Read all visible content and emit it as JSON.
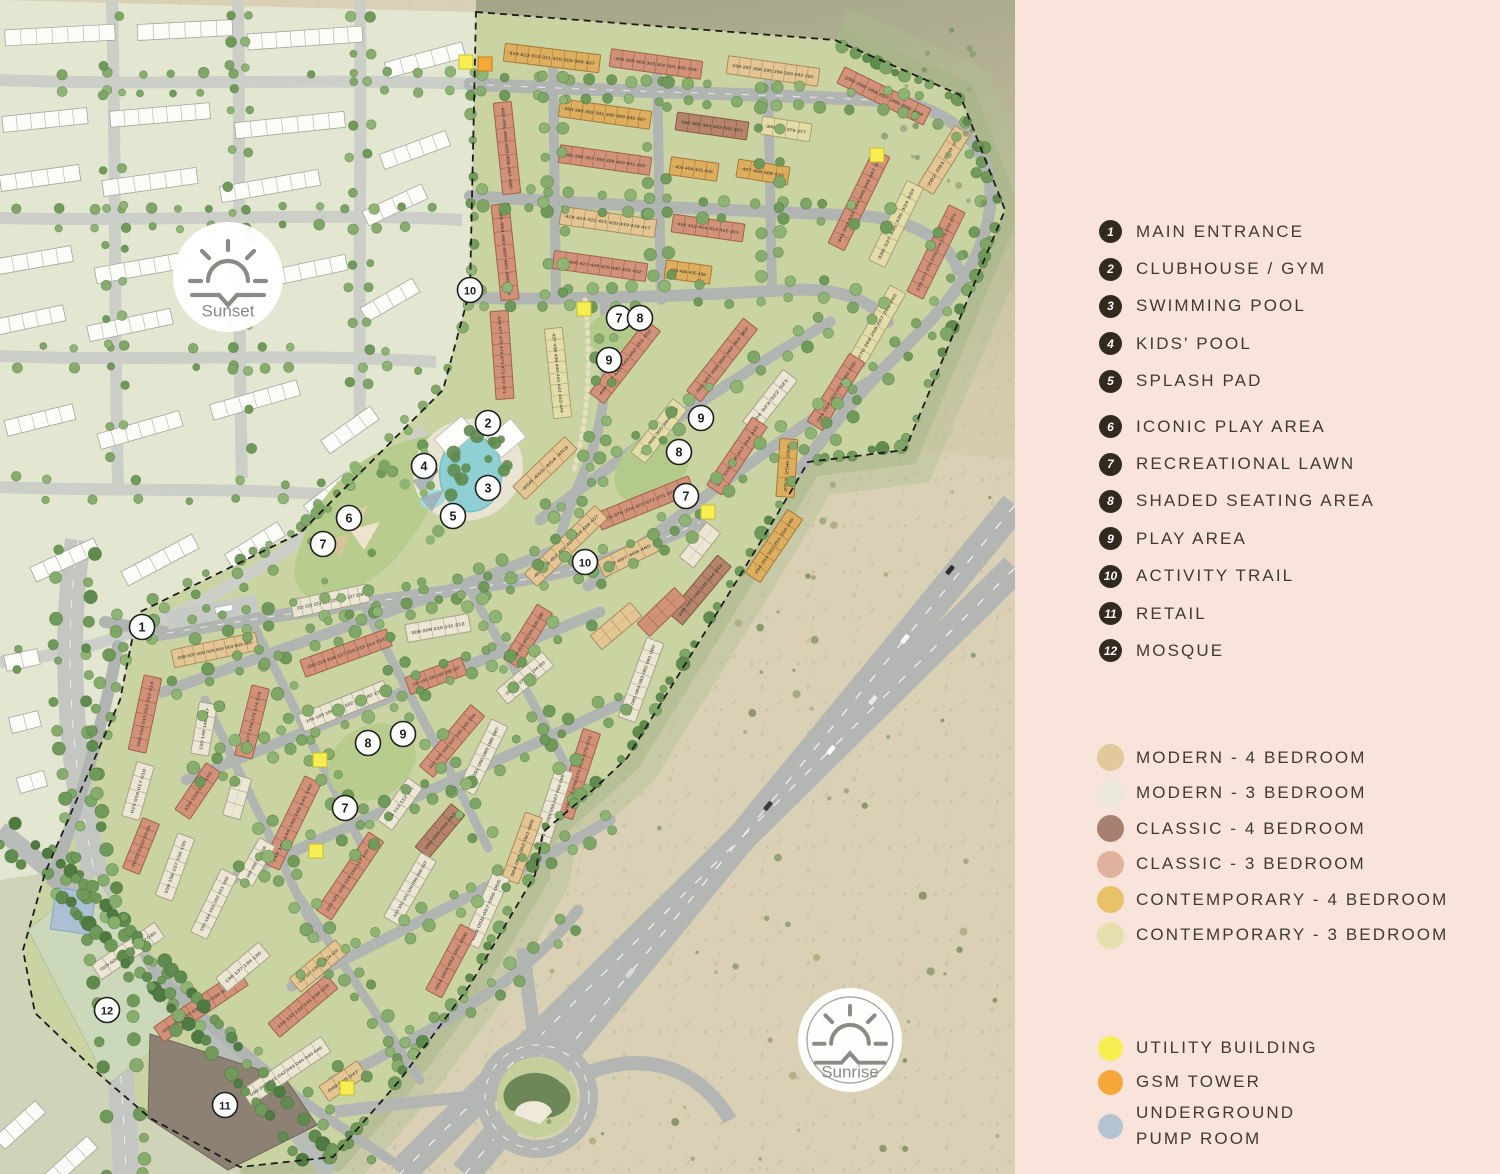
{
  "legend": {
    "amenities": [
      {
        "num": "1",
        "label": "MAIN ENTRANCE"
      },
      {
        "num": "2",
        "label": "CLUBHOUSE / GYM"
      },
      {
        "num": "3",
        "label": "SWIMMING POOL"
      },
      {
        "num": "4",
        "label": "KIDS' POOL"
      },
      {
        "num": "5",
        "label": "SPLASH PAD"
      },
      {
        "num": "6",
        "label": "ICONIC PLAY AREA"
      },
      {
        "num": "7",
        "label": "RECREATIONAL LAWN"
      },
      {
        "num": "8",
        "label": "SHADED SEATING AREA"
      },
      {
        "num": "9",
        "label": "PLAY AREA"
      },
      {
        "num": "10",
        "label": "ACTIVITY TRAIL"
      },
      {
        "num": "11",
        "label": "RETAIL"
      },
      {
        "num": "12",
        "label": "MOSQUE"
      }
    ],
    "unit_types": [
      {
        "label": "MODERN - 4 BEDROOM",
        "color": "#e2c99c"
      },
      {
        "label": "MODERN - 3 BEDROOM",
        "color": "#ebe8da"
      },
      {
        "label": "CLASSIC - 4 BEDROOM",
        "color": "#a8806f"
      },
      {
        "label": "CLASSIC - 3 BEDROOM",
        "color": "#e0b19c"
      },
      {
        "label": "CONTEMPORARY - 4 BEDROOM",
        "color": "#e9c169"
      },
      {
        "label": "CONTEMPORARY - 3 BEDROOM",
        "color": "#e6dfb0"
      }
    ],
    "facilities": [
      {
        "label": "UTILITY BUILDING",
        "color": "#f7ef52"
      },
      {
        "label": "GSM TOWER",
        "color": "#f6a73a"
      },
      {
        "label": "UNDERGROUND\nPUMP ROOM",
        "color": "#b5c4d2"
      }
    ]
  },
  "map": {
    "sun_badges": [
      {
        "type": "sunset",
        "label": "Sunset",
        "x": 228,
        "y": 277,
        "r": 55
      },
      {
        "type": "sunrise",
        "label": "Sunrise",
        "x": 850,
        "y": 1040,
        "r": 52
      }
    ],
    "markers": [
      {
        "n": "1",
        "x": 142,
        "y": 627
      },
      {
        "n": "2",
        "x": 488,
        "y": 423
      },
      {
        "n": "4",
        "x": 424,
        "y": 466
      },
      {
        "n": "3",
        "x": 488,
        "y": 488
      },
      {
        "n": "5",
        "x": 453,
        "y": 516
      },
      {
        "n": "6",
        "x": 349,
        "y": 518
      },
      {
        "n": "7",
        "x": 323,
        "y": 544
      },
      {
        "n": "10",
        "x": 470,
        "y": 290
      },
      {
        "n": "7",
        "x": 619,
        "y": 318
      },
      {
        "n": "8",
        "x": 640,
        "y": 318
      },
      {
        "n": "9",
        "x": 609,
        "y": 360
      },
      {
        "n": "9",
        "x": 701,
        "y": 418
      },
      {
        "n": "8",
        "x": 679,
        "y": 452
      },
      {
        "n": "7",
        "x": 686,
        "y": 496
      },
      {
        "n": "10",
        "x": 585,
        "y": 562
      },
      {
        "n": "9",
        "x": 403,
        "y": 734
      },
      {
        "n": "8",
        "x": 368,
        "y": 743
      },
      {
        "n": "7",
        "x": 345,
        "y": 808
      },
      {
        "n": "12",
        "x": 107,
        "y": 1010
      },
      {
        "n": "11",
        "x": 225,
        "y": 1105
      }
    ],
    "building_rows": [
      [
        552,
        58,
        96,
        7,
        "t4",
        "314 - 307"
      ],
      [
        656,
        64,
        92,
        8,
        "c3",
        "306 - 299"
      ],
      [
        773,
        71,
        92,
        8,
        "m4",
        "298 - 291"
      ],
      [
        884,
        96,
        96,
        26,
        "c3",
        "290 - 284"
      ],
      [
        944,
        160,
        70,
        -58,
        "m4",
        "282 - 279"
      ],
      [
        605,
        114,
        92,
        8,
        "t4",
        "394 - 387"
      ],
      [
        712,
        126,
        72,
        8,
        "c4",
        "386 - 381"
      ],
      [
        786,
        129,
        50,
        9,
        "t3",
        "380 - 377"
      ],
      [
        605,
        160,
        92,
        8,
        "c3",
        "395 - 402"
      ],
      [
        694,
        169,
        48,
        8,
        "t4",
        "403 - 406"
      ],
      [
        763,
        172,
        52,
        9,
        "t4",
        "407 - 410"
      ],
      [
        608,
        222,
        96,
        8,
        "m4",
        "424 - 417"
      ],
      [
        708,
        228,
        72,
        8,
        "c3",
        "416 - 411"
      ],
      [
        600,
        266,
        94,
        8,
        "c3",
        "425 - 432"
      ],
      [
        688,
        272,
        46,
        8,
        "t4",
        "433 - 436"
      ],
      [
        507,
        148,
        92,
        84,
        "c3",
        "492 - 486"
      ],
      [
        505,
        252,
        96,
        84,
        "c3",
        "485 - 479"
      ],
      [
        502,
        355,
        88,
        86,
        "c3",
        "478 - 471"
      ],
      [
        558,
        373,
        90,
        84,
        "t3",
        "437 - 444"
      ],
      [
        859,
        200,
        104,
        -64,
        "c3",
        "341 - 348"
      ],
      [
        896,
        224,
        88,
        -64,
        "t3",
        "338 - 333"
      ],
      [
        936,
        252,
        96,
        -64,
        "c3",
        "278 - 271"
      ],
      [
        877,
        326,
        84,
        -60,
        "t3",
        "270 - 265"
      ],
      [
        836,
        392,
        80,
        -58,
        "c3",
        "264 - 259"
      ],
      [
        625,
        362,
        92,
        -52,
        "c3",
        "446 - 452"
      ],
      [
        722,
        360,
        92,
        -52,
        "c3",
        "356 - 362"
      ],
      [
        770,
        401,
        66,
        -52,
        "m3",
        "324 - 321"
      ],
      [
        737,
        456,
        82,
        -56,
        "c3",
        "320 - 315"
      ],
      [
        659,
        431,
        68,
        -52,
        "t3",
        "367 - 363"
      ],
      [
        645,
        503,
        100,
        -22,
        "c3",
        "376 - 369"
      ],
      [
        787,
        468,
        58,
        -86,
        "t4",
        "257 - 255"
      ],
      [
        774,
        546,
        76,
        -56,
        "t4",
        "254 - 249"
      ],
      [
        545,
        468,
        72,
        -44,
        "m4",
        "456 - 453"
      ],
      [
        566,
        546,
        98,
        -44,
        "m4",
        "464 - 457"
      ],
      [
        628,
        556,
        60,
        -26,
        "m4",
        "468 - 465"
      ],
      [
        700,
        545,
        44,
        -52,
        "m3",
        null
      ],
      [
        700,
        590,
        76,
        -50,
        "c4",
        "248 - 243"
      ],
      [
        641,
        680,
        84,
        -70,
        "m3",
        "086 - 080"
      ],
      [
        616,
        626,
        52,
        -40,
        "m4",
        null
      ],
      [
        662,
        612,
        52,
        -44,
        "c3",
        null
      ],
      [
        330,
        601,
        78,
        -12,
        "m3",
        "221 - 228"
      ],
      [
        438,
        628,
        64,
        -10,
        "m3",
        "208 - 212"
      ],
      [
        346,
        653,
        92,
        -20,
        "c3",
        "220 - 213"
      ],
      [
        344,
        706,
        92,
        -22,
        "m3",
        "186 - 179"
      ],
      [
        436,
        676,
        60,
        -20,
        "c3",
        "192 - 187"
      ],
      [
        525,
        678,
        60,
        -40,
        "m3",
        "198 - 193"
      ],
      [
        528,
        636,
        64,
        -58,
        "c3",
        "204 - 199"
      ],
      [
        252,
        722,
        72,
        -76,
        "c3",
        "178 - 173"
      ],
      [
        204,
        729,
        52,
        -80,
        "m3",
        "150 - 147"
      ],
      [
        145,
        714,
        76,
        -78,
        "c3",
        "009 - 014"
      ],
      [
        215,
        650,
        86,
        -12,
        "m4",
        "008 - 001"
      ],
      [
        292,
        823,
        96,
        -64,
        "c3",
        "146 - 140"
      ],
      [
        198,
        791,
        56,
        -56,
        "c3",
        "154 - 151"
      ],
      [
        237,
        797,
        42,
        -74,
        "m3",
        "172 - 170"
      ],
      [
        400,
        804,
        52,
        -54,
        "m3",
        "114 - 111"
      ],
      [
        452,
        741,
        80,
        -50,
        "c3",
        "110 - 104"
      ],
      [
        483,
        757,
        76,
        -64,
        "m3",
        "092 - 087"
      ],
      [
        440,
        831,
        56,
        -50,
        "c4",
        "096 - 093"
      ],
      [
        350,
        876,
        94,
        -56,
        "c3",
        "122 - 115"
      ],
      [
        410,
        889,
        74,
        -60,
        "m3",
        "103 - 097"
      ],
      [
        175,
        867,
        66,
        -70,
        "m3",
        "159 - 155"
      ],
      [
        214,
        904,
        70,
        -64,
        "m3",
        "165 - 160"
      ],
      [
        256,
        862,
        46,
        -60,
        "m3",
        "169 - 166"
      ],
      [
        138,
        791,
        56,
        -74,
        "m3",
        "015 - 018"
      ],
      [
        141,
        846,
        54,
        -68,
        "c3",
        "019 - 024"
      ],
      [
        128,
        951,
        76,
        -34,
        "m3",
        "025 - 030"
      ],
      [
        201,
        1006,
        102,
        -34,
        "c3",
        "031 - 038"
      ],
      [
        286,
        1071,
        96,
        -34,
        "m3",
        "039 - 046"
      ],
      [
        318,
        966,
        60,
        -40,
        "m4",
        "128 - 123"
      ],
      [
        243,
        967,
        56,
        -40,
        "m3",
        "138 - 135"
      ],
      [
        303,
        1006,
        76,
        -40,
        "c3",
        "134 - 129"
      ],
      [
        343,
        1081,
        46,
        -34,
        "m4",
        "049 - 047"
      ],
      [
        578,
        774,
        90,
        -72,
        "c3",
        "078 - 072"
      ],
      [
        552,
        808,
        80,
        -72,
        "m3",
        "071 - 065"
      ],
      [
        522,
        848,
        70,
        -70,
        "m4",
        "064 - 060"
      ],
      [
        486,
        910,
        76,
        -66,
        "m3",
        "059 - 055"
      ],
      [
        451,
        961,
        74,
        -62,
        "c3",
        "054 - 050"
      ]
    ],
    "utilities": {
      "yellow": [
        [
          466,
          62
        ],
        [
          877,
          155
        ],
        [
          584,
          309
        ],
        [
          708,
          512
        ],
        [
          320,
          760
        ],
        [
          316,
          851
        ],
        [
          347,
          1088
        ]
      ],
      "orange": [
        [
          485,
          64
        ]
      ],
      "pump": {
        "x": 53,
        "y": 890,
        "w": 40,
        "h": 42,
        "angle": 8
      }
    }
  }
}
